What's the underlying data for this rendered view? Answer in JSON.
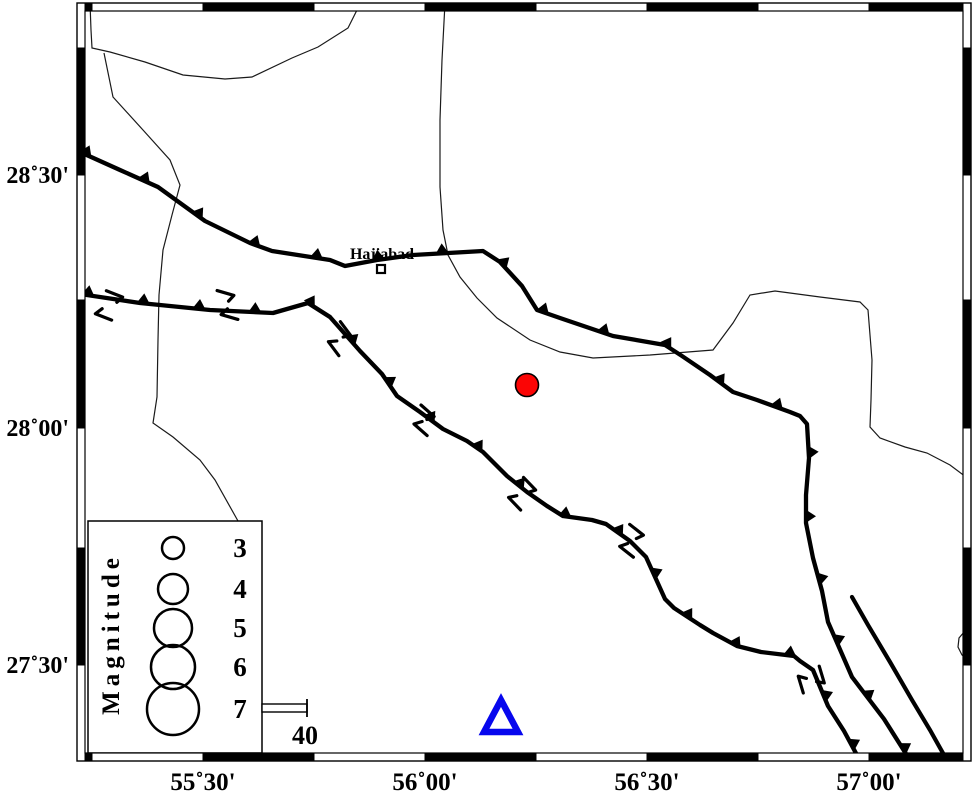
{
  "map": {
    "background": "#ffffff",
    "frame": {
      "outer": {
        "x": 77,
        "y": 3,
        "w": 894,
        "h": 758
      },
      "band": 8,
      "x_ticks": [
        92,
        203,
        314,
        425,
        536,
        647,
        758,
        869
      ],
      "y_ticks": [
        48,
        175,
        300,
        428,
        548,
        665
      ],
      "x_labels": [
        {
          "text": "55˚30'",
          "x": 203
        },
        {
          "text": "56˚00'",
          "x": 425
        },
        {
          "text": "56˚30'",
          "x": 647
        },
        {
          "text": "57˚00'",
          "x": 869
        }
      ],
      "y_labels": [
        {
          "text": "28˚30'",
          "y": 175
        },
        {
          "text": "28˚00'",
          "y": 428
        },
        {
          "text": "27˚30'",
          "y": 665
        }
      ]
    },
    "features": {
      "thrust_faults": [
        {
          "name": "north-thrust-fault",
          "teeth_spacing": 64,
          "teeth_offset": 6,
          "points": [
            [
              80,
              152
            ],
            [
              120,
              170
            ],
            [
              158,
              187
            ],
            [
              205,
              221
            ],
            [
              250,
              243
            ],
            [
              272,
              251
            ],
            [
              330,
              260
            ],
            [
              345,
              266
            ],
            [
              377,
              260
            ],
            [
              413,
              255
            ],
            [
              483,
              251
            ],
            [
              500,
              262
            ],
            [
              522,
              286
            ],
            [
              537,
              310
            ],
            [
              560,
              318
            ],
            [
              613,
              336
            ],
            [
              665,
              345
            ],
            [
              682,
              356
            ],
            [
              710,
              375
            ],
            [
              733,
              392
            ],
            [
              757,
              400
            ],
            [
              790,
              412
            ],
            [
              800,
              416
            ],
            [
              807,
              424
            ],
            [
              809,
              458
            ],
            [
              806,
              495
            ],
            [
              806,
              523
            ],
            [
              813,
              558
            ],
            [
              822,
              591
            ],
            [
              828,
              622
            ],
            [
              852,
              677
            ],
            [
              884,
              719
            ],
            [
              908,
              757
            ]
          ]
        },
        {
          "name": "south-thrust-fault",
          "teeth_spacing": 56,
          "teeth_offset": 8,
          "points": [
            [
              80,
              294
            ],
            [
              140,
              303
            ],
            [
              210,
              310
            ],
            [
              273,
              313
            ],
            [
              308,
              303
            ],
            [
              330,
              317
            ],
            [
              360,
              351
            ],
            [
              382,
              374
            ],
            [
              397,
              396
            ],
            [
              420,
              412
            ],
            [
              443,
              429
            ],
            [
              467,
              441
            ],
            [
              483,
              452
            ],
            [
              507,
              476
            ],
            [
              527,
              492
            ],
            [
              547,
              506
            ],
            [
              563,
              516
            ],
            [
              592,
              520
            ],
            [
              606,
              524
            ],
            [
              630,
              541
            ],
            [
              646,
              557
            ],
            [
              665,
              599
            ],
            [
              674,
              608
            ],
            [
              700,
              625
            ],
            [
              713,
              633
            ],
            [
              737,
              646
            ],
            [
              761,
              652
            ],
            [
              794,
              656
            ],
            [
              800,
              661
            ],
            [
              813,
              670
            ],
            [
              828,
              706
            ],
            [
              844,
              731
            ],
            [
              858,
              757
            ]
          ]
        }
      ],
      "plain_faults": [
        {
          "name": "plain-fault-segment",
          "points": [
            [
              852,
              597
            ],
            [
              868,
              625
            ],
            [
              890,
              662
            ],
            [
              912,
              700
            ],
            [
              930,
              730
            ],
            [
              944,
              755
            ]
          ]
        }
      ],
      "thin_lines": [
        {
          "name": "road-north",
          "points": [
            [
              90,
              3
            ],
            [
              91,
              30
            ],
            [
              92,
              48
            ],
            [
              110,
              52
            ],
            [
              145,
              62
            ],
            [
              183,
              75
            ],
            [
              225,
              79
            ],
            [
              252,
              77
            ],
            [
              292,
              58
            ],
            [
              318,
              47
            ],
            [
              348,
              28
            ],
            [
              358,
              8
            ],
            [
              360,
              3
            ]
          ]
        },
        {
          "name": "road-west",
          "points": [
            [
              104,
              53
            ],
            [
              113,
              97
            ],
            [
              143,
              130
            ],
            [
              170,
              160
            ],
            [
              180,
              185
            ],
            [
              172,
              215
            ],
            [
              163,
              250
            ],
            [
              159,
              295
            ],
            [
              158,
              340
            ],
            [
              157,
              397
            ],
            [
              153,
              423
            ],
            [
              173,
              437
            ],
            [
              200,
              460
            ],
            [
              215,
              480
            ],
            [
              238,
              521
            ]
          ]
        },
        {
          "name": "road-east",
          "points": [
            [
              445,
              3
            ],
            [
              442,
              60
            ],
            [
              440,
              120
            ],
            [
              440,
              187
            ],
            [
              443,
              230
            ],
            [
              448,
              255
            ],
            [
              460,
              277
            ],
            [
              477,
              298
            ],
            [
              497,
              318
            ],
            [
              530,
              340
            ],
            [
              560,
              352
            ],
            [
              593,
              358
            ],
            [
              650,
              355
            ],
            [
              713,
              350
            ],
            [
              733,
              323
            ],
            [
              750,
              295
            ],
            [
              775,
              291
            ],
            [
              820,
              297
            ],
            [
              860,
              302
            ],
            [
              868,
              310
            ],
            [
              872,
              360
            ],
            [
              871,
              400
            ],
            [
              870,
              427
            ],
            [
              880,
              438
            ],
            [
              905,
              447
            ],
            [
              927,
              453
            ],
            [
              950,
              465
            ],
            [
              966,
              477
            ]
          ]
        },
        {
          "name": "road-edge-bump",
          "points": [
            [
              965,
              631
            ],
            [
              959,
              638
            ],
            [
              958,
              647
            ],
            [
              962,
              655
            ],
            [
              966,
              658
            ]
          ]
        }
      ],
      "slip_marks": {
        "above": [
          [
            115,
            294,
            8
          ],
          [
            226,
            293,
            3
          ],
          [
            346,
            329,
            40
          ],
          [
            428,
            411,
            28
          ],
          [
            530,
            484,
            33
          ],
          [
            637,
            530,
            25
          ],
          [
            822,
            675,
            60
          ]
        ],
        "below": [
          [
            104,
            317,
            8
          ],
          [
            230,
            317,
            3
          ],
          [
            334,
            349,
            40
          ],
          [
            421,
            430,
            28
          ],
          [
            515,
            504,
            33
          ],
          [
            627,
            552,
            25
          ],
          [
            801,
            685,
            60
          ]
        ]
      },
      "town": {
        "label": "Hajiabad",
        "x": 381,
        "y": 269,
        "label_x": 382,
        "label_y": 259
      },
      "epicenter": {
        "x": 527,
        "y": 385,
        "r": 11.5,
        "fill": "#fb0505"
      },
      "station": {
        "apex_x": 501,
        "apex_y": 700,
        "half_base": 17,
        "height": 32,
        "color": "#0707ee"
      }
    },
    "legend": {
      "title": "Magnitude",
      "box": {
        "x": 88,
        "y": 521,
        "w": 174,
        "h": 232
      },
      "title_x": 119,
      "title_y": 634,
      "circle_x": 173,
      "label_x": 240,
      "entries": [
        {
          "label": "3",
          "y": 548,
          "r": 11
        },
        {
          "label": "4",
          "y": 589,
          "r": 15
        },
        {
          "label": "5",
          "y": 628,
          "r": 19
        },
        {
          "label": "6",
          "y": 667,
          "r": 22
        },
        {
          "label": "7",
          "y": 709,
          "r": 26
        }
      ],
      "scale_bar": {
        "label": "40",
        "x": 262,
        "y": 704,
        "w": 45,
        "h": 8,
        "label_x": 305,
        "label_y": 744
      }
    }
  }
}
